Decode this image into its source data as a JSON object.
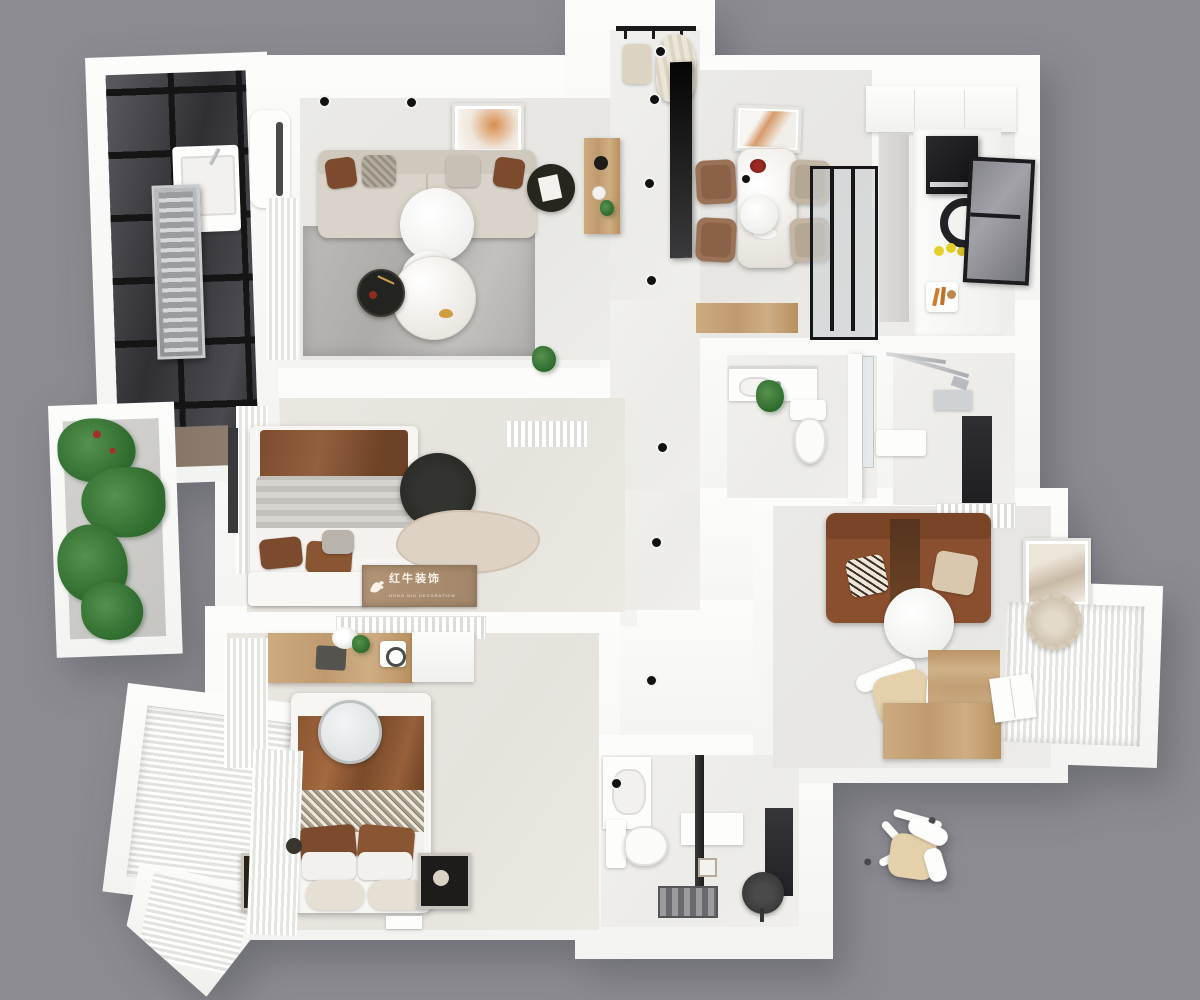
{
  "scene": {
    "description": "Photorealistic top-down 3D floor plan render of a three-bedroom apartment",
    "background_color": "#8b8b91"
  },
  "watermark": {
    "brand": "红牛装饰",
    "brand_subtext": "HONG NIU DECORATION",
    "icon": "bull-logo-icon",
    "panel_color": "#ad9379",
    "text_color": "#f8f2e7"
  },
  "palette": {
    "background": "#8b8b91",
    "wall": "#f9f9f8",
    "wall_shadow": "#dcdcda",
    "floor": "#e9e8e5",
    "rug": "#b4b3b0",
    "wood": "#cdab80",
    "wood_dark": "#ab9078",
    "sofa_beige": "#d9d3c9",
    "sofa_brown": "#8a4f2e",
    "pillow_brown": "#7c4a2c",
    "blanket_brown": "#8a5533",
    "accent_black": "#1c1c1e",
    "plant_green": "#3f7d3c",
    "glass_dark": "#3a3a3e",
    "lemon_yellow": "#e3cf2a",
    "carrot_orange": "#d07b2e",
    "marble": "#efece7",
    "seat_tan": "#e4d0aa",
    "chair_brown": "#9a7258"
  }
}
